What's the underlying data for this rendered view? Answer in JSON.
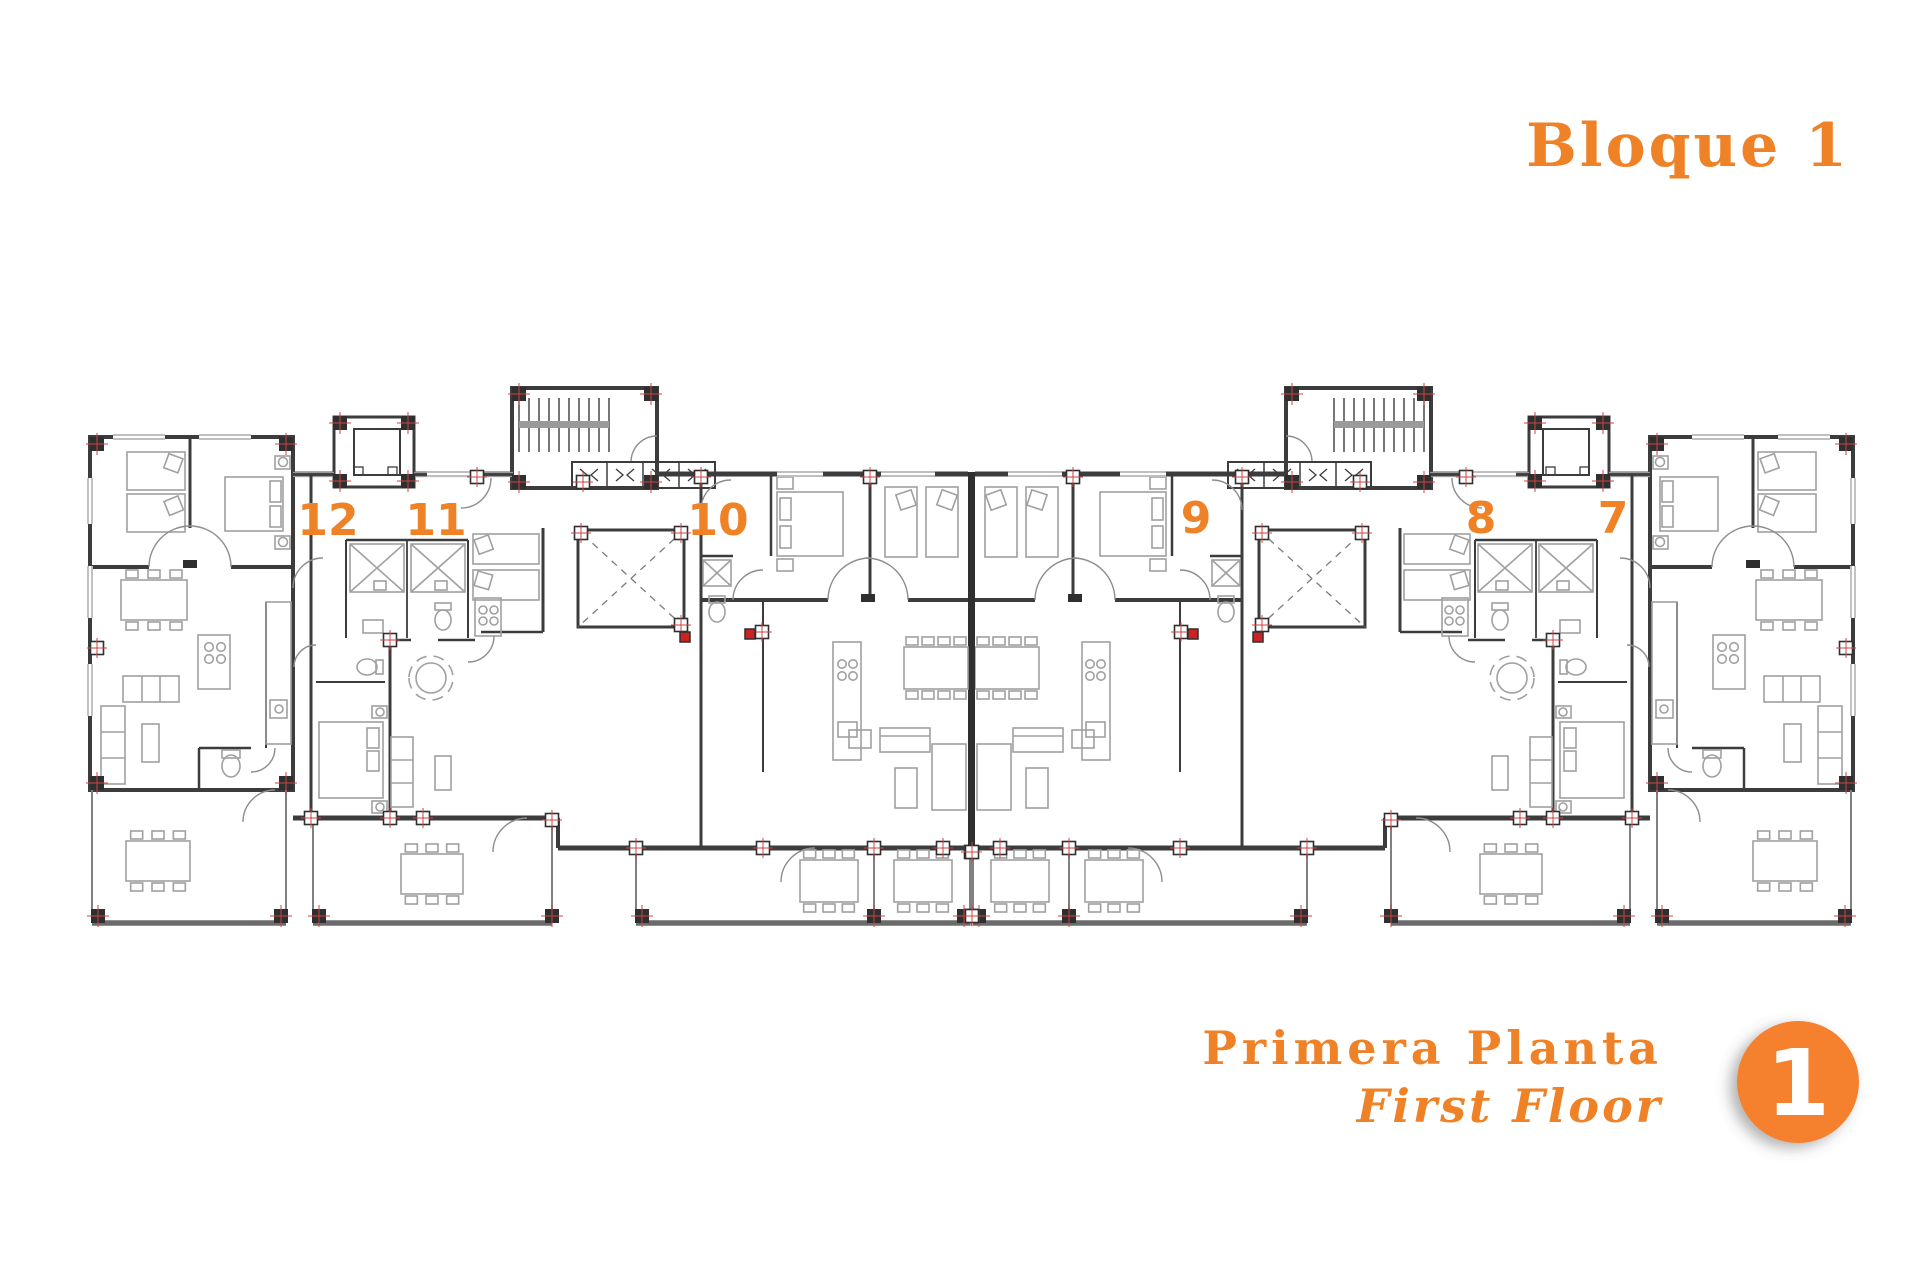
{
  "header": {
    "title": "Bloque 1"
  },
  "footer": {
    "floor_name_spanish": "Primera Planta",
    "floor_name_english": "First Floor",
    "badge_number": "1"
  },
  "apartments": [
    {
      "number": "12"
    },
    {
      "number": "11"
    },
    {
      "number": "10"
    },
    {
      "number": "9"
    },
    {
      "number": "8"
    },
    {
      "number": "7"
    }
  ],
  "colors": {
    "accent_orange": "#ef8227",
    "badge_orange": "#f5802e",
    "wall_dark": "#3c3c3c",
    "furniture_gray": "#a0a0a0",
    "terrace_gray": "#808080",
    "marker_red": "#cc4444",
    "window_gray": "#999999"
  },
  "plan_symbols": {
    "stair-run-icon": "parallel-treads-with-handrail",
    "elevator-shaft-icon": "square-with-inner-car",
    "light-well-icon": "square-with-dashed-x",
    "column-marker-icon": "red-crosshair-square",
    "storage-cell-icon": "angle-bracket-pair"
  }
}
